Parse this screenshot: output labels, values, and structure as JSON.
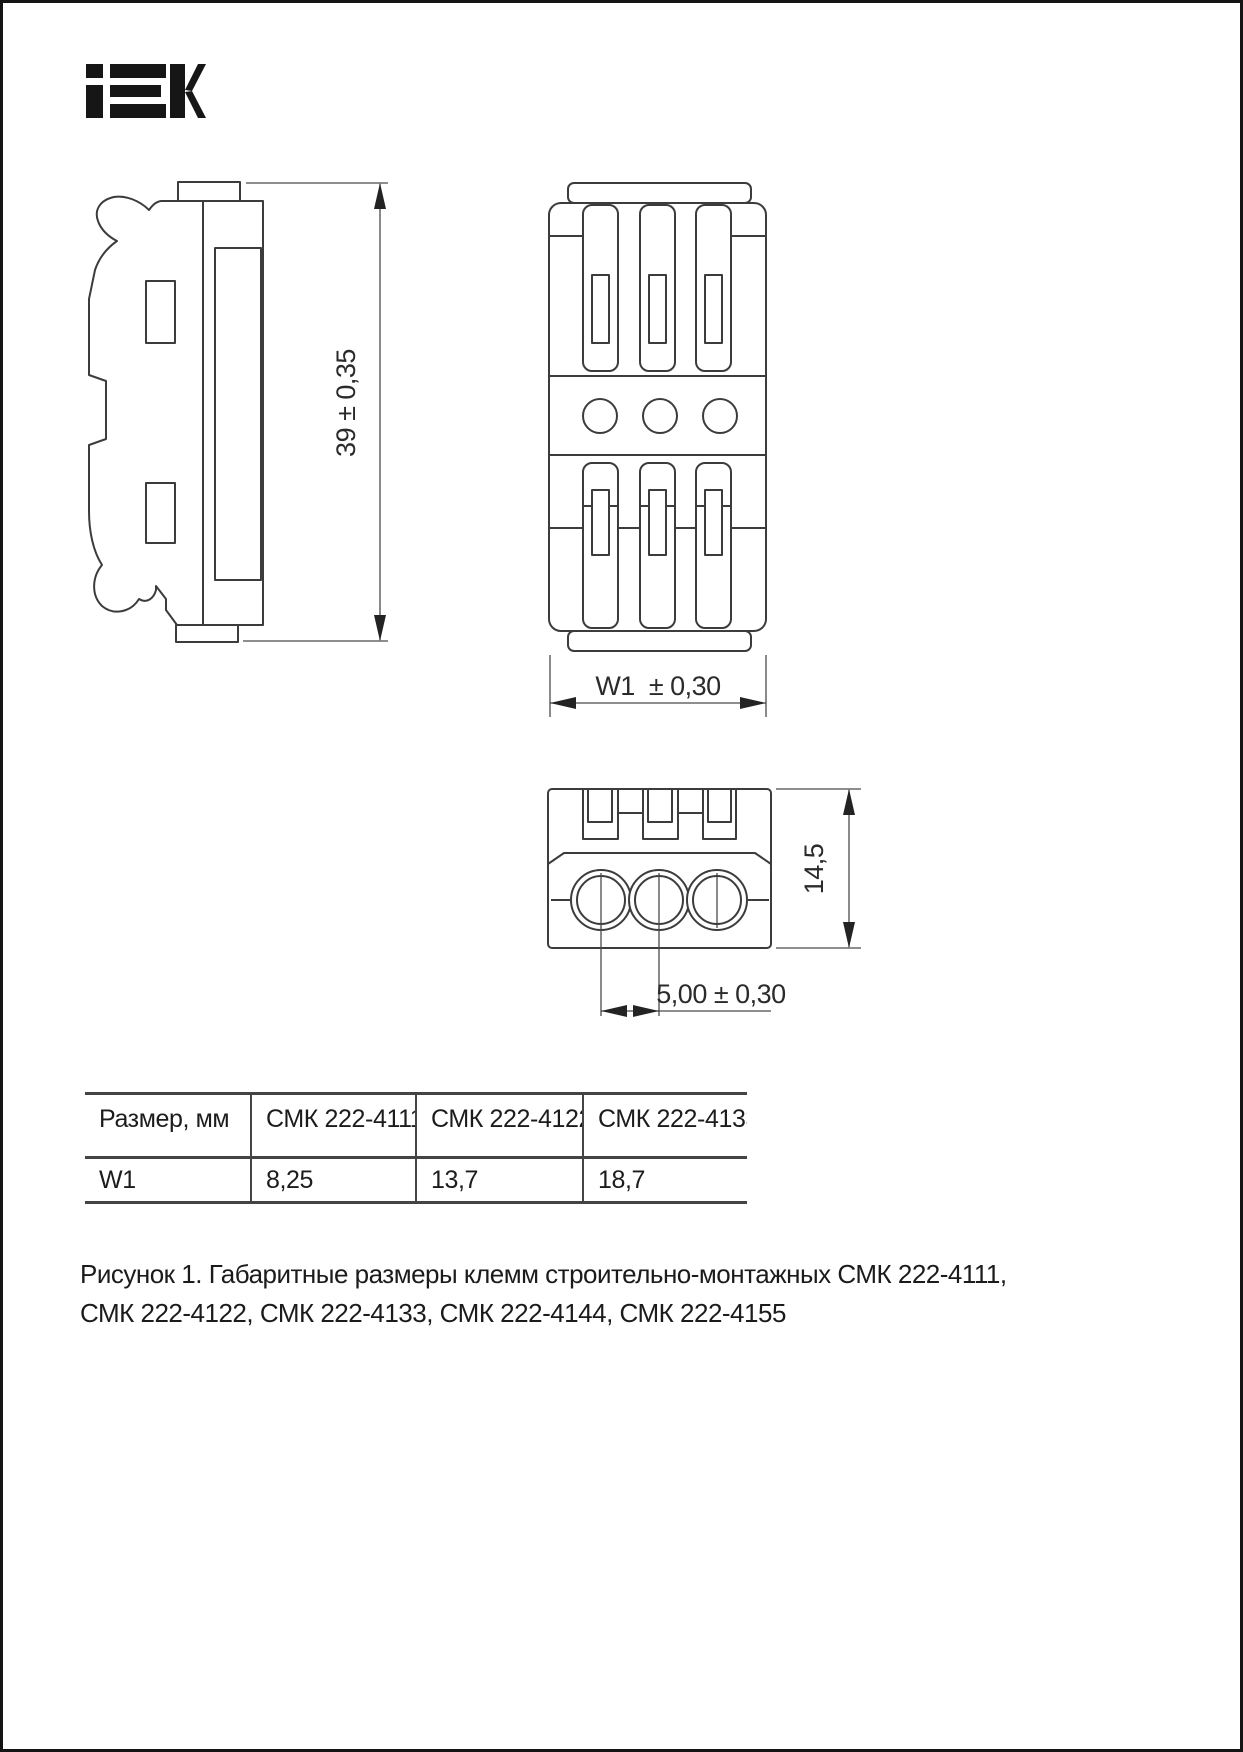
{
  "brand": {
    "name": "IEK"
  },
  "drawings": {
    "side_view": {
      "height_dim": "39 ± 0,35"
    },
    "front_view": {
      "width_dim": "W1  ± 0,30"
    },
    "end_view": {
      "height_dim": "14,5",
      "pitch_dim": "5,00 ± 0,30"
    }
  },
  "table": {
    "headers": [
      "Размер, мм",
      "СМК 222-4111",
      "СМК 222-4122",
      "СМК 222-4133"
    ],
    "rows": [
      [
        "W1",
        "8,25",
        "13,7",
        "18,7"
      ]
    ]
  },
  "caption": {
    "line1": "Рисунок 1. Габаритные размеры клемм строительно-монтажных СМК 222-4111,",
    "line2": "СМК 222-4122, СМК 222-4133, СМК 222-4144, СМК 222-4155"
  },
  "colors": {
    "ink": "#1c1c1c",
    "line": "#3c3c3c",
    "background": "#ffffff"
  }
}
